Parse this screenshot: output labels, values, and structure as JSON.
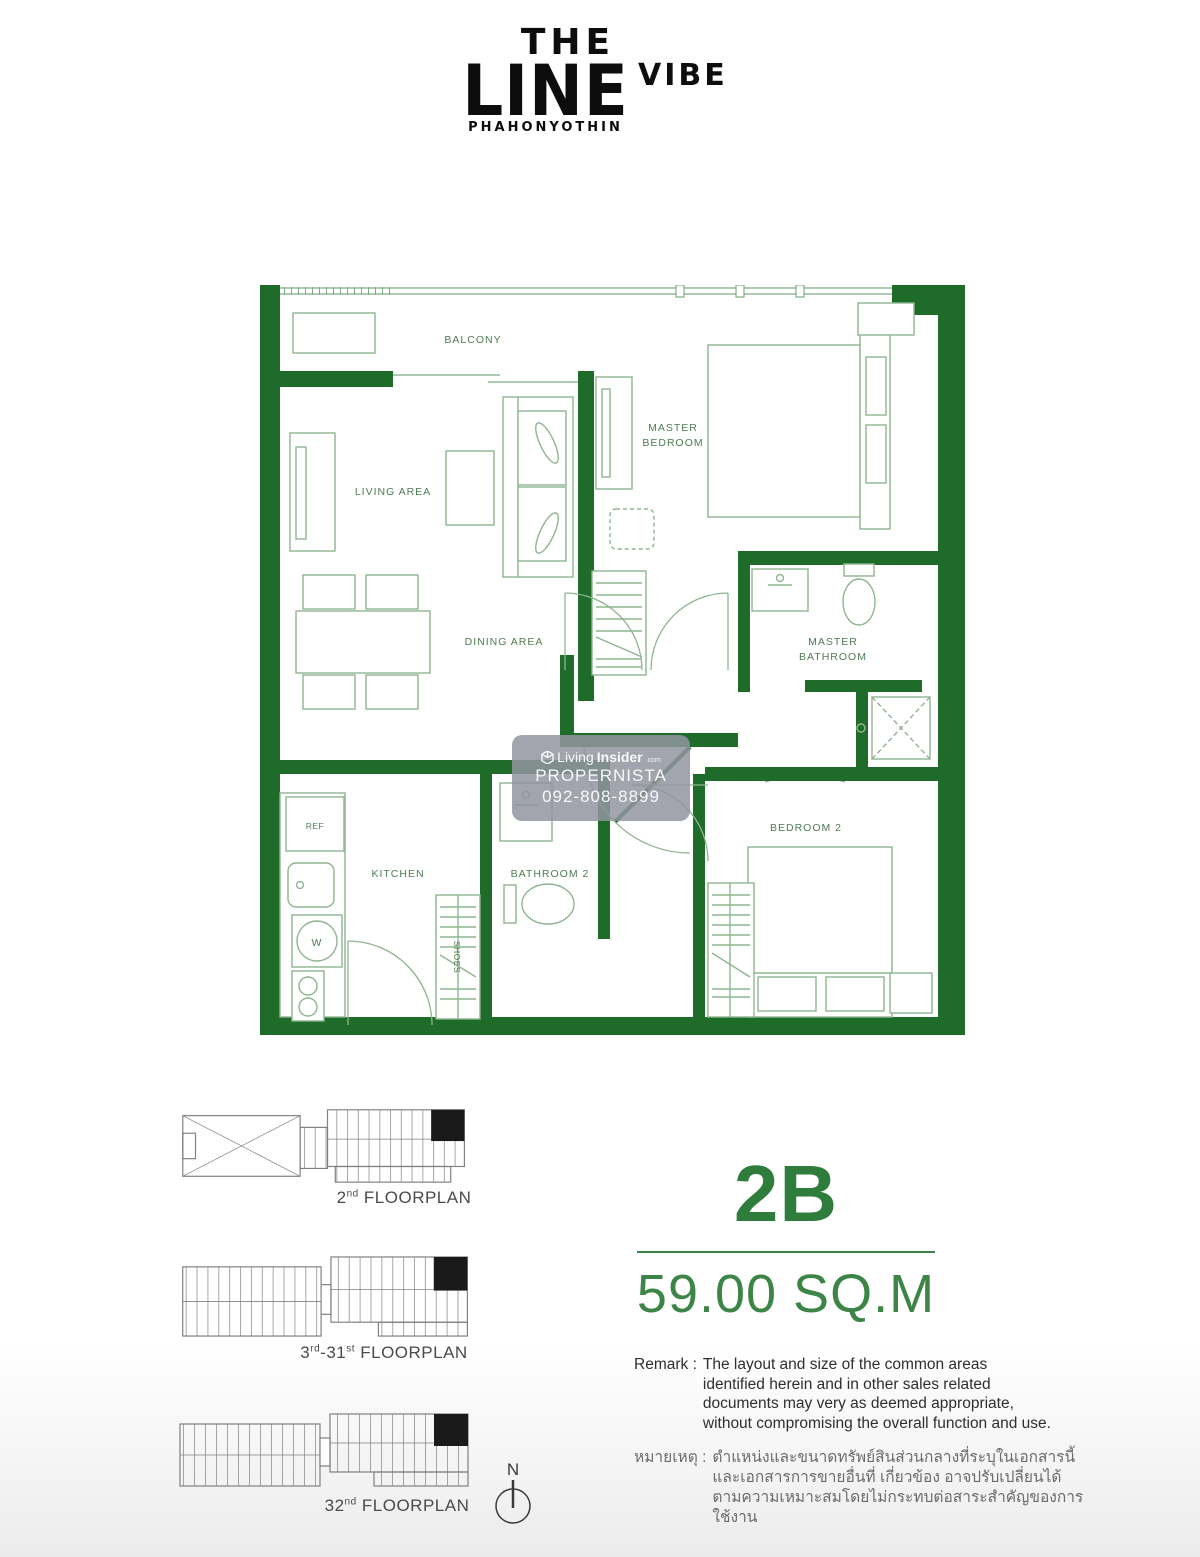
{
  "logo": {
    "line1": "THE",
    "line2": "LINE",
    "line3": "VIBE",
    "subtitle": "PHAHONYOTHIN"
  },
  "plan": {
    "rooms": {
      "balcony": "BALCONY",
      "living": "LIVING AREA",
      "dining": "DINING AREA",
      "master_bedroom_1": "MASTER",
      "master_bedroom_2": "BEDROOM",
      "master_bathroom_1": "MASTER",
      "master_bathroom_2": "BATHROOM",
      "bathroom2": "BATHROOM 2",
      "bedroom2": "BEDROOM 2",
      "kitchen": "KITCHEN",
      "ref": "REF",
      "washer": "W",
      "shoes": "SHOES"
    }
  },
  "watermark": {
    "brand_light": "Living",
    "brand_bold": "Insider",
    "brand_suffix": ".com",
    "line2": "PROPERNISTA",
    "line3": "092-808-8899"
  },
  "floorplans": [
    {
      "p1": "2",
      "s1": "nd",
      "p2": "",
      "s2": "",
      "p3": " FLOORPLAN"
    },
    {
      "p1": "3",
      "s1": "rd",
      "p2": "-31",
      "s2": "st",
      "p3": " FLOORPLAN"
    },
    {
      "p1": "32",
      "s1": "nd",
      "p2": "",
      "s2": "",
      "p3": " FLOORPLAN"
    }
  ],
  "unit": {
    "type": "2B",
    "area": "59.00 SQ.M"
  },
  "remark_en": {
    "label": "Remark :",
    "text": "The layout and size of the common areas\nidentified herein and in other sales related\ndocuments may very as deemed appropriate,\nwithout compromising the overall function and use."
  },
  "remark_th": {
    "label": "หมายเหตุ :",
    "text": "ตำแหน่งและขนาดทรัพย์สินส่วนกลางที่ระบุในเอกสารนี้\nและเอกสารการขายอื่นที่ เกี่ยวข้อง อาจปรับเปลี่ยนได้\nตามความเหมาะสมโดยไม่กระทบต่อสาระสำคัญของการใช้งาน"
  },
  "compass": {
    "label": "N"
  },
  "colors": {
    "wall_green": "#1f6b29",
    "furniture_green": "#8fb591",
    "label_green": "#4e7c52",
    "accent_green": "#2e7d3c",
    "logo_black": "#0d0d0d",
    "thumbnail_gray": "#808080",
    "highlight_unit_black": "#1a1a1a"
  }
}
